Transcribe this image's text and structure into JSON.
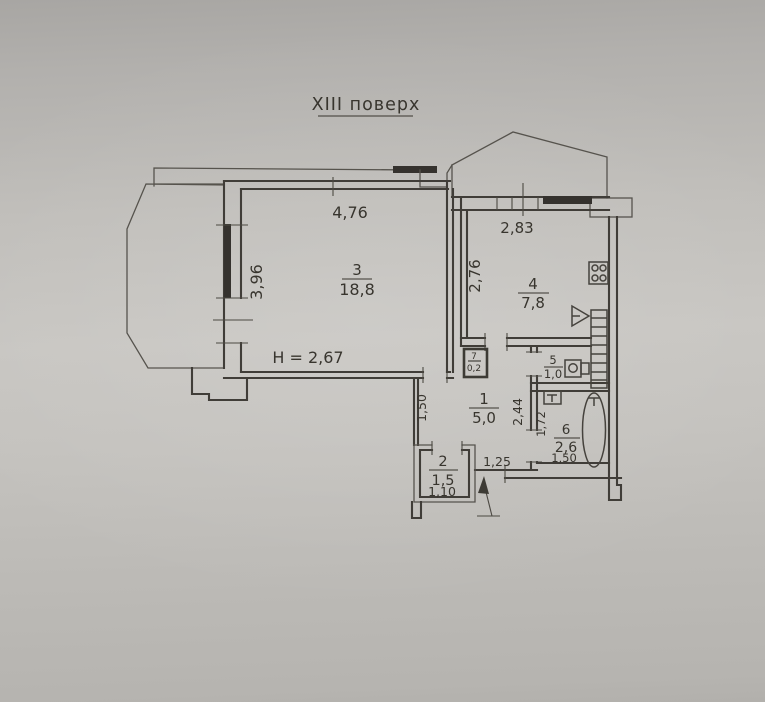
{
  "title": "XIII поверх",
  "plan": {
    "ceiling_height": "H = 2,67",
    "rooms": [
      {
        "number": "1",
        "area": "5,0"
      },
      {
        "number": "2",
        "area": "1,5"
      },
      {
        "number": "3",
        "area": "18,8"
      },
      {
        "number": "4",
        "area": "7,8"
      },
      {
        "number": "5",
        "area": "1,0"
      },
      {
        "number": "6",
        "area": "2,6"
      },
      {
        "number": "7",
        "area": "0,2"
      }
    ],
    "dimensions": {
      "room3_width": "4,76",
      "room3_depth": "3,96",
      "room4_width": "2,83",
      "room4_depth": "2,76",
      "hall_depth": "1,50",
      "hall_width": "2,44",
      "entry_opening": "1,25",
      "room2_width": "1,10",
      "room6_depth": "1,72",
      "room6_width": "1,50"
    },
    "colors": {
      "paper": "#c7c5c1",
      "ink": "#3e3b36",
      "window_hatch": "#34322d"
    },
    "fixtures": [
      "stove",
      "sink",
      "toilet",
      "bathtub",
      "vent",
      "shaft-ladder",
      "entrance-arrow"
    ]
  }
}
